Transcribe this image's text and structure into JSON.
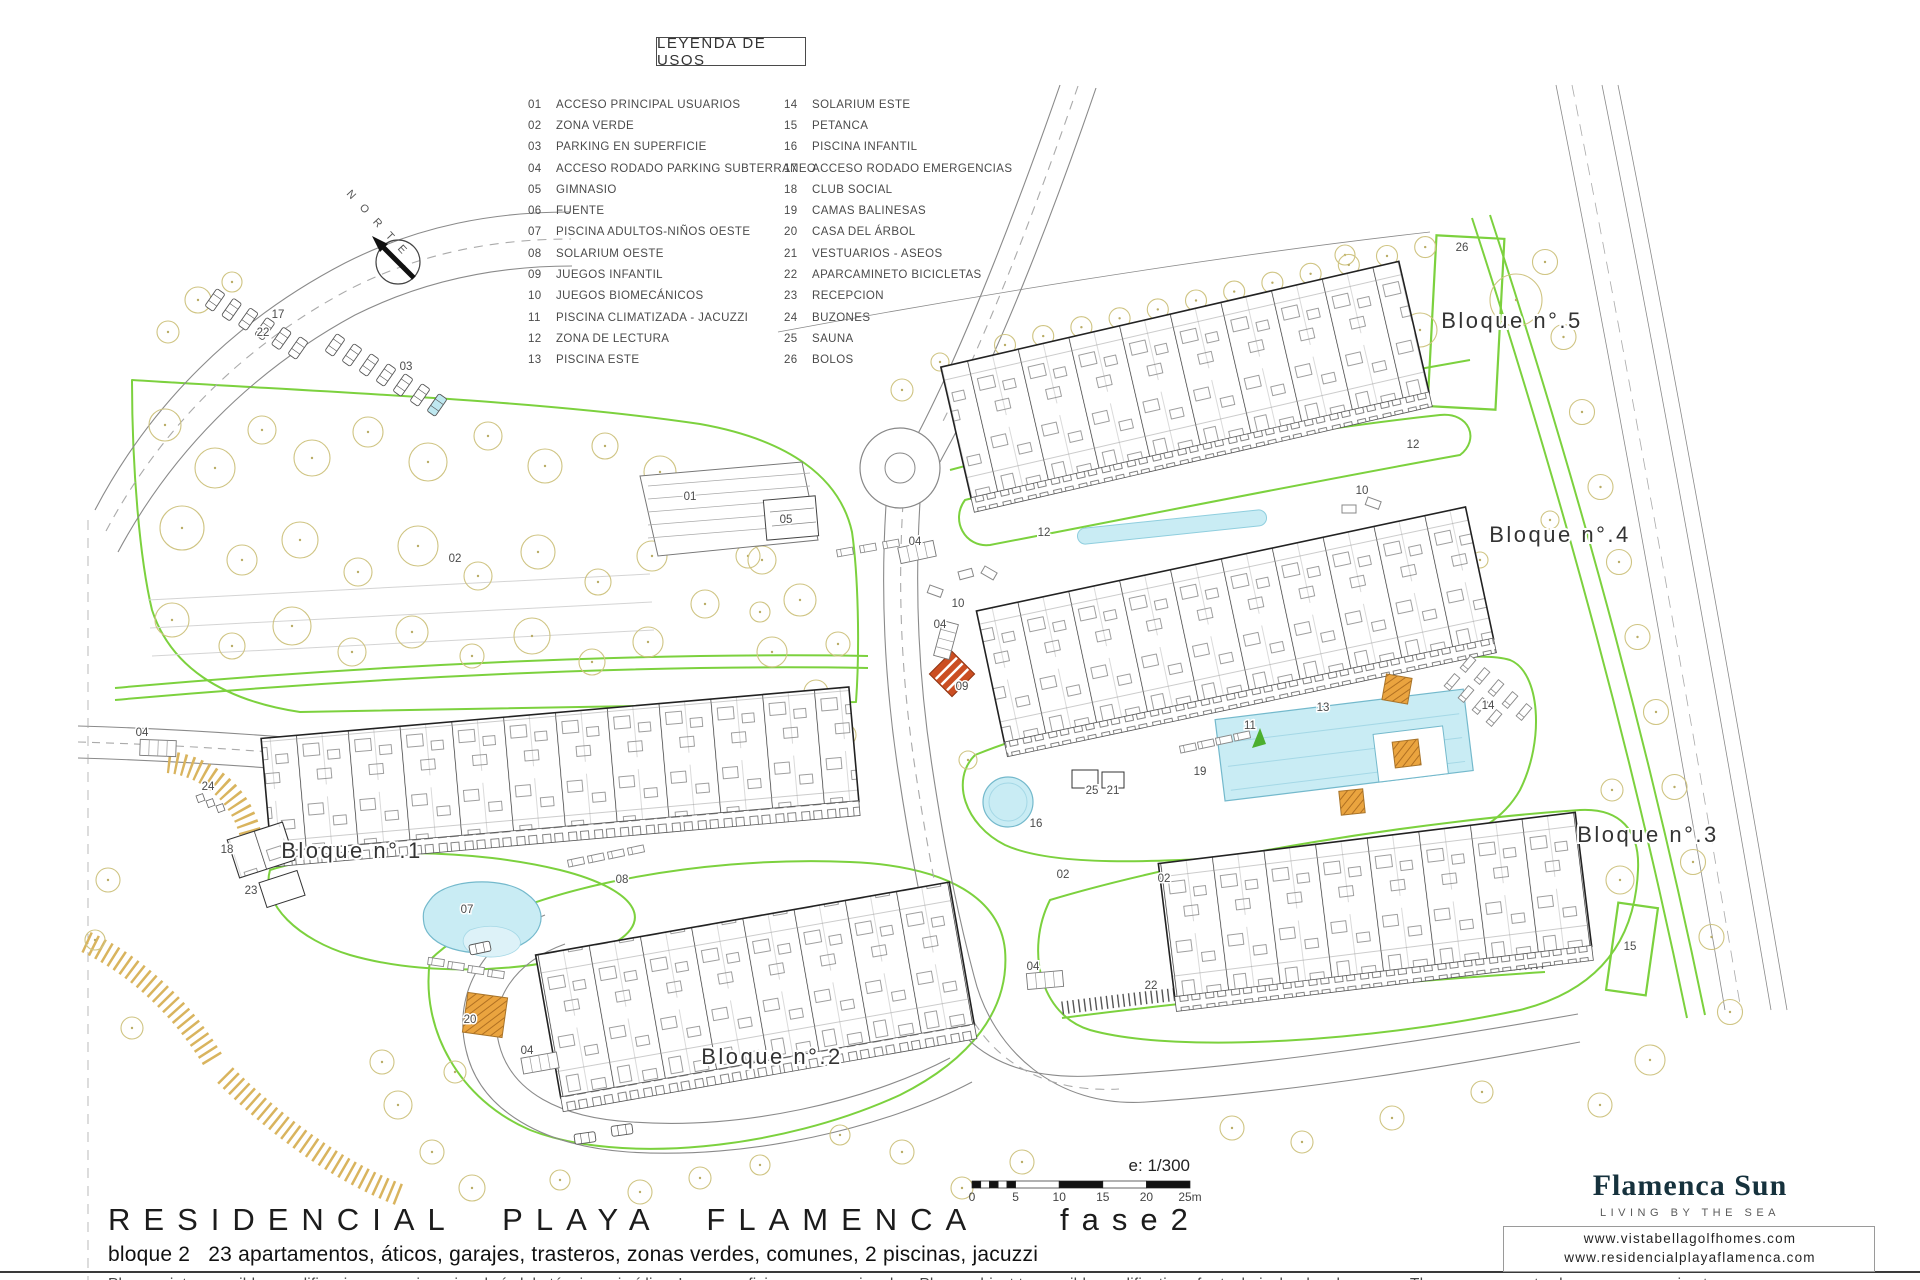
{
  "document": {
    "project": "RESIDENCIAL PLAYA FLAMENCA",
    "phase": "fase2",
    "description": "bloque 2   23 apartamentos, áticos, garajes, trasteros, zonas verdes, comunes, 2 piscinas, jacuzzi",
    "disclaimer": "Plano sujeto a posibles modificaciones o exigencias de índole técnico o jurídica. Las superficies son aproximadas. Plans subject to possible modifications for technical or legal reasons. The measurements shown are approximate."
  },
  "legend": {
    "title": "LEYENDA DE USOS",
    "items_left": [
      {
        "num": "01",
        "label": "ACCESO PRINCIPAL USUARIOS"
      },
      {
        "num": "02",
        "label": "ZONA VERDE"
      },
      {
        "num": "03",
        "label": "PARKING EN SUPERFICIE"
      },
      {
        "num": "04",
        "label": "ACCESO RODADO PARKING SUBTERRANEO"
      },
      {
        "num": "05",
        "label": "GIMNASIO"
      },
      {
        "num": "06",
        "label": "FUENTE"
      },
      {
        "num": "07",
        "label": "PISCINA ADULTOS-NIÑOS OESTE"
      },
      {
        "num": "08",
        "label": "SOLARIUM OESTE"
      },
      {
        "num": "09",
        "label": "JUEGOS INFANTIL"
      },
      {
        "num": "10",
        "label": "JUEGOS BIOMECÁNICOS"
      },
      {
        "num": "11",
        "label": "PISCINA CLIMATIZADA - JACUZZI"
      },
      {
        "num": "12",
        "label": "ZONA DE LECTURA"
      },
      {
        "num": "13",
        "label": "PISCINA ESTE"
      }
    ],
    "items_right": [
      {
        "num": "14",
        "label": "SOLARIUM ESTE"
      },
      {
        "num": "15",
        "label": "PETANCA"
      },
      {
        "num": "16",
        "label": "PISCINA INFANTIL"
      },
      {
        "num": "17",
        "label": "ACCESO RODADO EMERGENCIAS"
      },
      {
        "num": "18",
        "label": "CLUB SOCIAL"
      },
      {
        "num": "19",
        "label": "CAMAS BALINESAS"
      },
      {
        "num": "20",
        "label": "CASA DEL ÁRBOL"
      },
      {
        "num": "21",
        "label": "VESTUARIOS - ASEOS"
      },
      {
        "num": "22",
        "label": "APARCAMINETO BICICLETAS"
      },
      {
        "num": "23",
        "label": "RECEPCION"
      },
      {
        "num": "24",
        "label": "BUZONES"
      },
      {
        "num": "25",
        "label": "SAUNA"
      },
      {
        "num": "26",
        "label": "BOLOS"
      }
    ]
  },
  "plan": {
    "north_label": "NORTE",
    "blocks": [
      {
        "label": "Bloque n°.1",
        "x": 352,
        "y": 858
      },
      {
        "label": "Bloque n°.2",
        "x": 772,
        "y": 1064
      },
      {
        "label": "Bloque n°.3",
        "x": 1648,
        "y": 842
      },
      {
        "label": "Bloque n°.4",
        "x": 1560,
        "y": 542
      },
      {
        "label": "Bloque n°.5",
        "x": 1512,
        "y": 328
      }
    ],
    "markers": [
      {
        "n": "01",
        "x": 690,
        "y": 500
      },
      {
        "n": "02",
        "x": 455,
        "y": 562
      },
      {
        "n": "02",
        "x": 1063,
        "y": 878
      },
      {
        "n": "02",
        "x": 1164,
        "y": 882
      },
      {
        "n": "03",
        "x": 406,
        "y": 370
      },
      {
        "n": "04",
        "x": 142,
        "y": 736
      },
      {
        "n": "04",
        "x": 915,
        "y": 545
      },
      {
        "n": "04",
        "x": 940,
        "y": 628
      },
      {
        "n": "04",
        "x": 527,
        "y": 1054
      },
      {
        "n": "04",
        "x": 1033,
        "y": 970
      },
      {
        "n": "05",
        "x": 786,
        "y": 523
      },
      {
        "n": "07",
        "x": 467,
        "y": 913
      },
      {
        "n": "08",
        "x": 622,
        "y": 883
      },
      {
        "n": "09",
        "x": 962,
        "y": 690
      },
      {
        "n": "10",
        "x": 958,
        "y": 607
      },
      {
        "n": "10",
        "x": 1362,
        "y": 494
      },
      {
        "n": "11",
        "x": 1250,
        "y": 729
      },
      {
        "n": "12",
        "x": 1044,
        "y": 536
      },
      {
        "n": "12",
        "x": 1413,
        "y": 448
      },
      {
        "n": "13",
        "x": 1323,
        "y": 711
      },
      {
        "n": "14",
        "x": 1488,
        "y": 709
      },
      {
        "n": "15",
        "x": 1630,
        "y": 950
      },
      {
        "n": "16",
        "x": 1036,
        "y": 827
      },
      {
        "n": "17",
        "x": 278,
        "y": 318
      },
      {
        "n": "18",
        "x": 227,
        "y": 853
      },
      {
        "n": "19",
        "x": 1200,
        "y": 775
      },
      {
        "n": "20",
        "x": 470,
        "y": 1023
      },
      {
        "n": "21",
        "x": 1113,
        "y": 794
      },
      {
        "n": "22",
        "x": 263,
        "y": 336
      },
      {
        "n": "22",
        "x": 1151,
        "y": 989
      },
      {
        "n": "23",
        "x": 251,
        "y": 894
      },
      {
        "n": "24",
        "x": 208,
        "y": 790
      },
      {
        "n": "25",
        "x": 1092,
        "y": 794
      },
      {
        "n": "26",
        "x": 1462,
        "y": 251
      }
    ]
  },
  "scale": {
    "label": "e: 1/300",
    "ticks": [
      "0",
      "5",
      "10",
      "15",
      "20",
      "25m"
    ]
  },
  "brand": {
    "name": "Flamenca Sun",
    "tagline": "LIVING BY THE SEA",
    "urls": [
      "www.vistabellagolfhomes.com",
      "www.residencialplayaflamenca.com"
    ]
  },
  "colors": {
    "zone_green": "#7cd13e",
    "water": "#c9ecf4",
    "tree": "#cfc482",
    "brand_yellow": "#f0b929",
    "brand_orange": "#f09a28",
    "brand_dark_orange": "#e8821e",
    "brand_blue": "#56b7ce",
    "brand_teal": "#2b9f98"
  }
}
